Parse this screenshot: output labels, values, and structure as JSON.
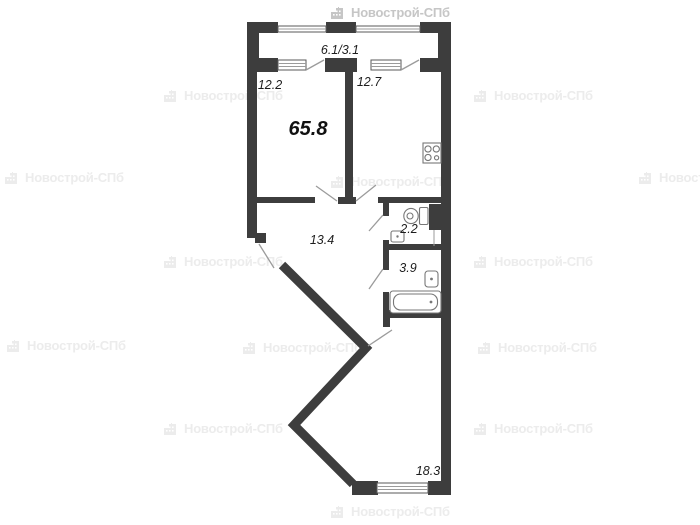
{
  "watermark": {
    "text": "Новострой-СПб",
    "icon": "building-icon",
    "color_faint": "#ececec",
    "color_strong": "#c6c6c6",
    "positions": [
      {
        "x": 330,
        "y": 5,
        "strong": true
      },
      {
        "x": 163,
        "y": 88,
        "strong": false
      },
      {
        "x": 473,
        "y": 88,
        "strong": false
      },
      {
        "x": 4,
        "y": 170,
        "strong": false
      },
      {
        "x": 330,
        "y": 174,
        "strong": false
      },
      {
        "x": 638,
        "y": 170,
        "strong": false
      },
      {
        "x": 163,
        "y": 254,
        "strong": false
      },
      {
        "x": 473,
        "y": 254,
        "strong": false
      },
      {
        "x": 6,
        "y": 338,
        "strong": false
      },
      {
        "x": 242,
        "y": 340,
        "strong": false
      },
      {
        "x": 477,
        "y": 340,
        "strong": false
      },
      {
        "x": 163,
        "y": 421,
        "strong": false
      },
      {
        "x": 473,
        "y": 421,
        "strong": false
      },
      {
        "x": 330,
        "y": 504,
        "strong": false
      }
    ]
  },
  "plan": {
    "type": "apartment-floor-plan",
    "total_area_label": "65.8",
    "colors": {
      "wall": "#3d3d3d",
      "thin_line": "#9b9b9b",
      "fixture_line": "#777777",
      "label_text": "#1d1d1d"
    },
    "rooms": [
      {
        "id": "balcony",
        "label": "6.1/3.1",
        "area": "6.1/3.1"
      },
      {
        "id": "room-12-2",
        "label": "12.2",
        "area": 12.2
      },
      {
        "id": "kitchen-12-7",
        "label": "12.7",
        "area": 12.7
      },
      {
        "id": "hallway",
        "label": "13.4",
        "area": 13.4
      },
      {
        "id": "wc",
        "label": "2.2",
        "area": 2.2
      },
      {
        "id": "bathroom",
        "label": "3.9",
        "area": 3.9
      },
      {
        "id": "living-room",
        "label": "18.3",
        "area": 18.3
      }
    ],
    "fixtures": [
      "stove-icon",
      "toilet-icon",
      "sink-icon",
      "washbasin-icon",
      "bathtub-icon"
    ]
  }
}
